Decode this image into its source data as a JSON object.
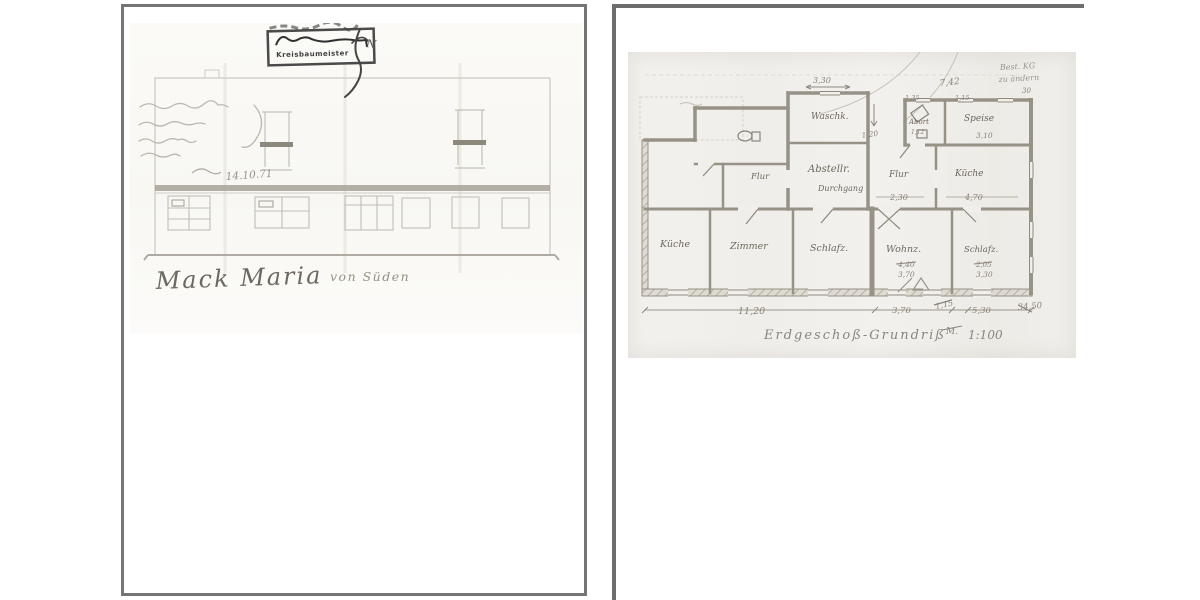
{
  "left_page": {
    "stamp_label": "Kreisbaumeister",
    "north_mark": "N",
    "date_note": "14.10.71",
    "name_caption": "Mack Maria",
    "view_caption": "von Süden"
  },
  "right_page": {
    "corner_note_1": "Best. KG",
    "corner_note_2": "zu ändern",
    "rooms": {
      "waschk": "Waschk.",
      "abort": "Abort",
      "speise": "Speise",
      "flur_left": "Flur",
      "abstellr": "Abstellr.",
      "durchgang": "Durchgang",
      "flur_right": "Flur",
      "kueche_right": "Küche",
      "kueche_left": "Küche",
      "zimmer": "Zimmer",
      "schlafz_mid": "Schlafz.",
      "wohnz": "Wohnz.",
      "schlafz_right": "Schlafz."
    },
    "dims": {
      "waschk_top": "3,30",
      "block_top": "7,42",
      "block_left": "1,35",
      "block_right": "1,15",
      "corner_right": "30",
      "vert": "1,20",
      "abort": "1,12",
      "speise": "3,10",
      "flur": "2,30",
      "kueche": "4,70",
      "wohnz_a": "4,40",
      "wohnz_b": "3,70",
      "schlafz_a": "2,05",
      "schlafz_b": "3,30",
      "bottom_1": "11,20",
      "bottom_2": "3,70",
      "bottom_3": "1,15",
      "bottom_4": "5,30",
      "bottom_5": "34,50"
    },
    "title": {
      "text": "Erdgeschoß-Grundriß",
      "struck": "M.",
      "scale": "1:100"
    }
  }
}
